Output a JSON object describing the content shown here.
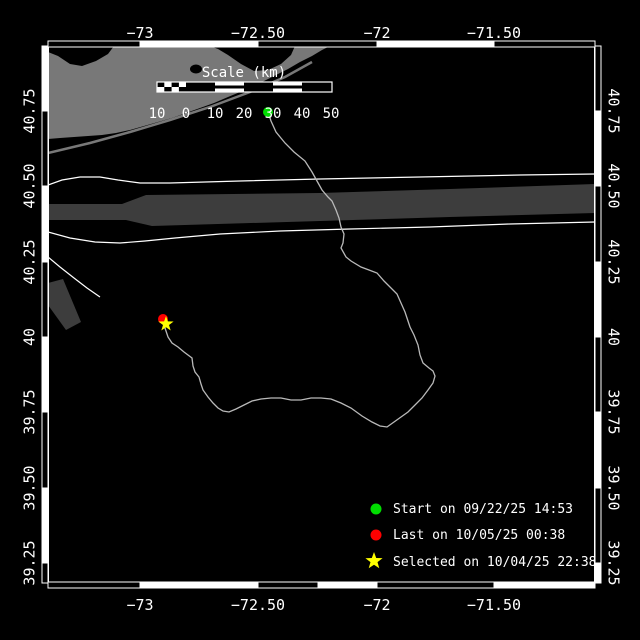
{
  "colors": {
    "background": "#000000",
    "land": "#787878",
    "shipping_lane": "#3d3d3d",
    "lane_boundary": "#ffffff",
    "track": "#b9b9b9",
    "frame": "#ffffff",
    "start_marker": "#00dd00",
    "last_marker": "#ff0000",
    "selected_marker": "#ffff00",
    "label_text": "#ffffff"
  },
  "axes": {
    "top": {
      "labels": [
        "−73",
        "−72.50",
        "−72",
        "−71.50"
      ]
    },
    "bottom": {
      "labels": [
        "−73",
        "−72.50",
        "−72",
        "−71.50"
      ]
    },
    "left": {
      "labels": [
        "40.75",
        "40.50",
        "40.25",
        "40",
        "39.75",
        "39.50",
        "39.25"
      ]
    },
    "right": {
      "labels": [
        "40.75",
        "40.50",
        "40.25",
        "40",
        "39.75",
        "39.50",
        "39.25"
      ]
    }
  },
  "scale_bar": {
    "title": "Scale (km)",
    "units": "km",
    "tick_labels": [
      "10",
      "0",
      "10",
      "20",
      "30",
      "40",
      "50"
    ]
  },
  "legend": {
    "items": [
      {
        "marker": "circle",
        "color": "#00dd00",
        "label": "Start on 09/22/25 14:53"
      },
      {
        "marker": "circle",
        "color": "#ff0000",
        "label": "Last on 10/05/25 00:38"
      },
      {
        "marker": "star",
        "color": "#ffff00",
        "label": "Selected on 10/04/25 22:38"
      }
    ]
  },
  "track": {
    "points": "268,112 271,121 276,132 285,143 294,152 305,161 312,172 317,181 322,190 328,197 332,201 336,210 339,218 341,227 344,234 343,243 341,248 346,257 351,261 361,267 369,270 377,273 384,281 390,287 397,294 401,303 405,312 407,318 410,327 414,335 418,345 420,355 423,363 429,368 433,371 435,376 433,383 428,390 422,398 415,405 408,412 401,417 394,422 387,427 380,426 372,422 362,416 351,408 341,403 331,399 321,398 311,398 301,400 291,400 281,398 271,398 261,399 252,401 244,405 236,409 229,412 223,411 218,408 213,403 208,397 203,390 201,384 199,377 195,372 193,366 192,358 184,352 178,347 172,343 168,337 165,328 163,321"
  },
  "markers": {
    "start": {
      "cx": "268",
      "cy": "112",
      "r": "5"
    },
    "last": {
      "cx": "163",
      "cy": "319",
      "r": "5"
    },
    "selected": {
      "points": "166,316 167.9,321.4 173.6,321.5 169,325 170.7,330.5 166,327.2 161.3,330.5 163,325 158.4,321.5 164.1,321.4"
    }
  }
}
